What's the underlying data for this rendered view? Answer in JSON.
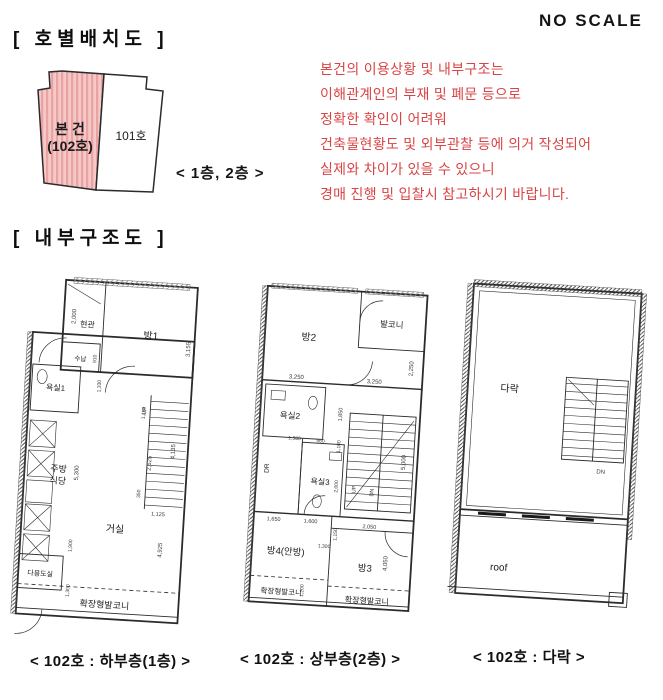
{
  "colors": {
    "notice_red": "#d94444",
    "subject_red": "#e01212",
    "highlight_pink": "#f6c8c8",
    "highlight_stripe": "#e9a3a3",
    "line_dark": "#2b2b2b"
  },
  "titles": {
    "unit_layout": "[ 호별배치도 ]",
    "no_scale": "NO SCALE",
    "internal_structure": "[ 내부구조도 ]"
  },
  "site_plan": {
    "subject_line1": "본 건",
    "subject_line2": "(102호)",
    "neighbor_unit": "101호",
    "floors_note": "< 1층, 2층 >"
  },
  "notice": {
    "line1": "본건의 이용상황 및 내부구조는",
    "line2": "이해관계인의 부재 및 폐문 등으로",
    "line3": "정확한 확인이 어려워",
    "line4": "건축물현황도 및 외부관찰 등에 의거 작성되어",
    "line5": "실제와 차이가 있을 수 있으니",
    "line6": "경매 진행 및 입찰시  참고하시기 바랍니다."
  },
  "plan1": {
    "caption": "< 102호 : 하부층(1층) >",
    "rooms": {
      "entry": "현관",
      "room1": "방1",
      "storage": "수납",
      "bath1": "욕실1",
      "kitchen_line1": "주방",
      "kitchen_line2": "식당",
      "living": "거실",
      "utility": "다용도실",
      "balcony": "확장형발코니"
    },
    "stair_label": "UP",
    "dims": {
      "d2000": "2,000",
      "d910": "910",
      "d1330": "1,330",
      "d3155": "3,155",
      "d1150": "1,150",
      "d4135": "4,135",
      "d2625": "2,625",
      "d5300": "5,300",
      "d350": "350",
      "d1125": "1,125",
      "d1900": "1,900",
      "d1300": "1,300",
      "d4925": "4,925"
    }
  },
  "plan2": {
    "caption": "< 102호 : 상부층(2층) >",
    "rooms": {
      "room2": "방2",
      "balcony_top": "발코니",
      "bath2": "욕실2",
      "dress": "DR",
      "bath3": "욕실3",
      "room4": "방4(안방)",
      "room3": "방3",
      "balcony_left": "확장형발코니",
      "balcony_right": "확장형발코니"
    },
    "stair_up": "UP",
    "stair_dn": "DN",
    "dims": {
      "a3250": "3,250",
      "b3250": "3,250",
      "d2250": "2,250",
      "d1850": "1,850",
      "d1380": "1,380",
      "d560": "560",
      "d1100": "1,100",
      "d2000": "2,000",
      "d1650": "1,650",
      "d1600": "1,600",
      "d1150": "1,150",
      "d2050": "2,050",
      "d1300": "1,300",
      "d4050": "4,050",
      "d1200": "1,200",
      "d5000": "5,000"
    }
  },
  "plan3": {
    "caption": "< 102호 : 다락 >",
    "rooms": {
      "attic": "다락",
      "roof": "roof"
    },
    "stair_label": "DN"
  }
}
